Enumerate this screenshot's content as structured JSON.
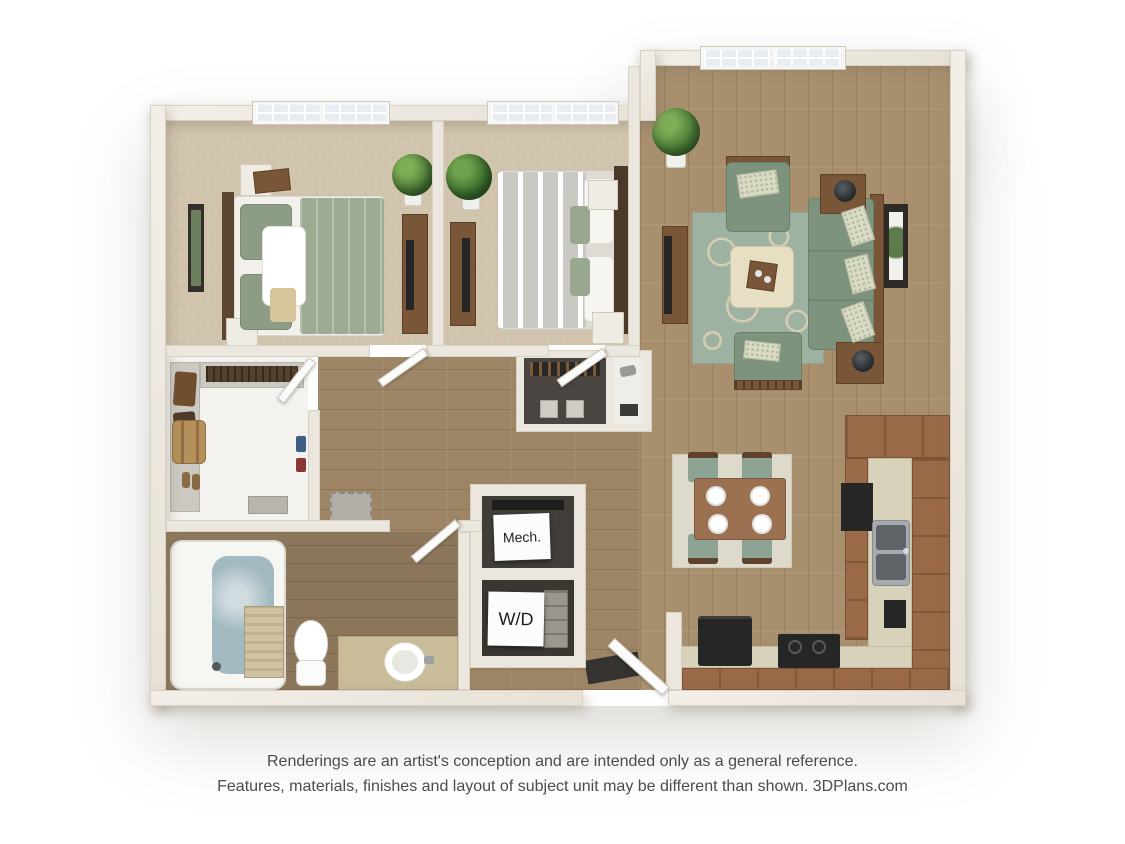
{
  "plan": {
    "labels": {
      "mech": "Mech.",
      "washer_dryer": "W/D"
    }
  },
  "footer": {
    "line1": "Renderings are an artist's conception and are intended only as a general reference.",
    "line2": "Features, materials, finishes and layout of subject unit may be different than shown. 3DPlans.com"
  },
  "palette": {
    "background": "#ffffff",
    "wall": "#ece7de",
    "wood_floor": "#a8906e",
    "hall_wood_floor": "#9d8565",
    "bath_wood_floor": "#8d775c",
    "bedroom_carpet": "#d2c5ae",
    "living_rug_green": "#9eb2a1",
    "rug_pattern_cream": "#d6cdb2",
    "sofa_green": "#7d937e",
    "furniture_wood": "#7a5638",
    "kitchen_cabinet_brown": "#9a6947",
    "countertop_cream": "#d8d2ba",
    "appliance_black": "#262626",
    "tub_water_blue": "#a2b9c1",
    "vanity_tan": "#c9bc99",
    "closet_dark_interior": "#413d38",
    "window_pane": "#e7edf2",
    "footer_text": "#4c4c4c"
  }
}
